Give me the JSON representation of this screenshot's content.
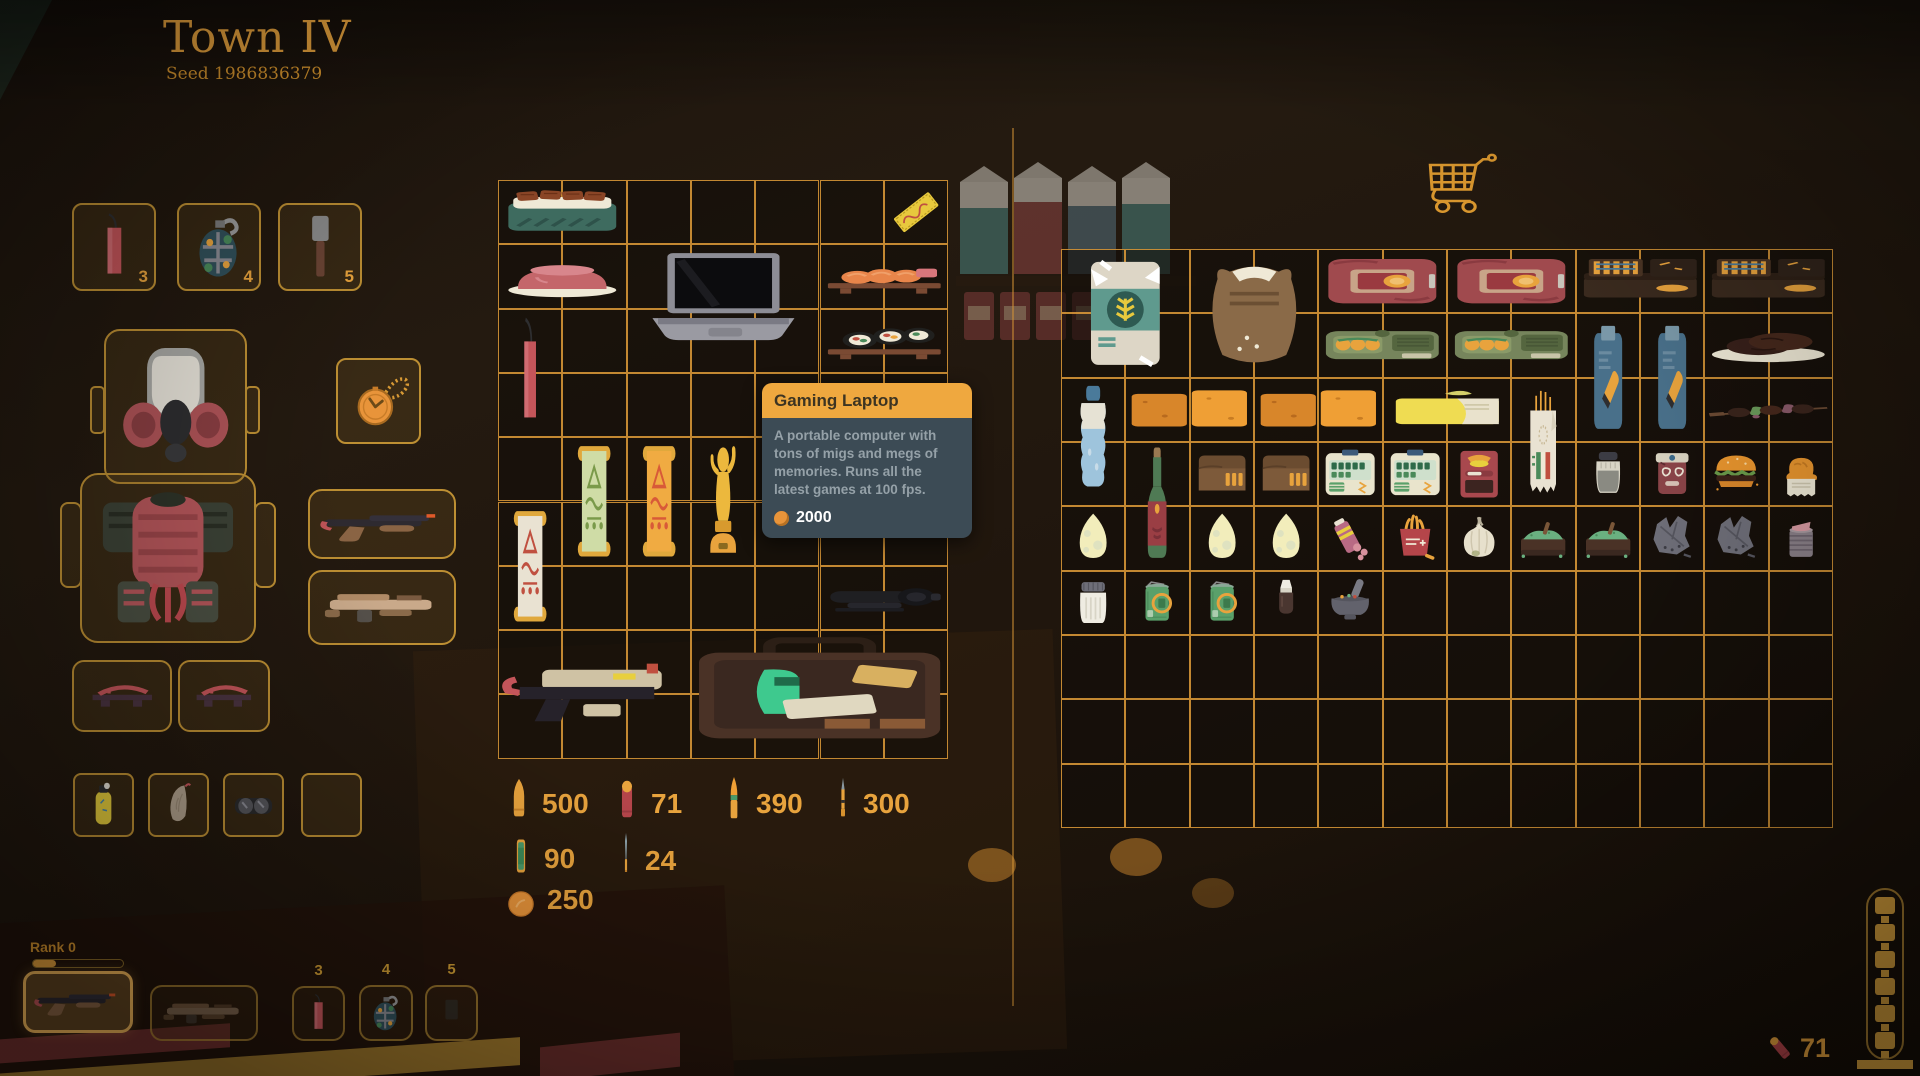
{
  "header": {
    "title": "Town IV",
    "seed": "Seed 1986836379"
  },
  "colors": {
    "accent_orange": "#e8a33d",
    "grid_line": "#de9e3a",
    "tooltip_header_bg": "#efa83f",
    "tooltip_body_bg": "#3c4b55",
    "tooltip_text": "#95a1a8",
    "selected_slot": "#f2b659"
  },
  "equipment": {
    "quick_slots": [
      {
        "name": "dynamite",
        "icon": "dynamite",
        "count": "3"
      },
      {
        "name": "grenade",
        "icon": "grenade",
        "count": "4"
      },
      {
        "name": "stick-grenade",
        "icon": "stick-grenade",
        "count": "5"
      }
    ],
    "head": {
      "icon": "gas-mask"
    },
    "trinket": {
      "icon": "pocket-watch"
    },
    "body": {
      "icon": "samurai-armor"
    },
    "weapons": [
      {
        "name": "shotgun",
        "icon": "shotgun"
      },
      {
        "name": "rifle",
        "icon": "smg"
      }
    ],
    "shoes": [
      {
        "icon": "geta"
      },
      {
        "icon": "geta"
      }
    ],
    "misc": [
      {
        "icon": "canister-yellow"
      },
      {
        "icon": "lung"
      },
      {
        "icon": "goggles"
      },
      {
        "icon": null
      }
    ]
  },
  "player_grid": {
    "cols": 7,
    "rows": 9,
    "items": [
      {
        "name": "unagi-bento",
        "icon": "unagi-bento",
        "col": 0,
        "row": 0,
        "w": 2,
        "h": 1
      },
      {
        "name": "golden-ticket",
        "icon": "golden-ticket",
        "col": 6,
        "row": 0,
        "w": 1,
        "h": 1
      },
      {
        "name": "ham-plate",
        "icon": "ham-plate",
        "col": 0,
        "row": 1,
        "w": 2,
        "h": 1
      },
      {
        "name": "gaming-laptop",
        "icon": "laptop",
        "col": 2,
        "row": 1,
        "w": 3,
        "h": 2
      },
      {
        "name": "salmon-sushi-board",
        "icon": "sushi-board",
        "col": 5,
        "row": 1,
        "w": 2,
        "h": 1
      },
      {
        "name": "maki-roll-board",
        "icon": "maki-board",
        "col": 5,
        "row": 2,
        "w": 2,
        "h": 1
      },
      {
        "name": "dynamite-stick",
        "icon": "dynamite",
        "col": 0,
        "row": 2,
        "w": 1,
        "h": 2
      },
      {
        "name": "scroll-green",
        "icon": "scroll-green",
        "col": 1,
        "row": 4,
        "w": 1,
        "h": 2
      },
      {
        "name": "scroll-orange",
        "icon": "scroll-orange",
        "col": 2,
        "row": 4,
        "w": 1,
        "h": 2
      },
      {
        "name": "gold-trophy",
        "icon": "trophy",
        "col": 3,
        "row": 4,
        "w": 1,
        "h": 2
      },
      {
        "name": "drink-cup",
        "icon": "drink-cup",
        "col": 6,
        "row": 4,
        "w": 1,
        "h": 2
      },
      {
        "name": "scroll-white",
        "icon": "scroll-white",
        "col": 0,
        "row": 5,
        "w": 1,
        "h": 2
      },
      {
        "name": "rifle-scope",
        "icon": "scope",
        "col": 5,
        "row": 6,
        "w": 2,
        "h": 1
      },
      {
        "name": "pistol",
        "icon": "pistol-tan",
        "col": 0,
        "row": 7,
        "w": 3,
        "h": 2
      },
      {
        "name": "toolbox",
        "icon": "toolbox",
        "col": 3,
        "row": 7,
        "w": 4,
        "h": 2
      }
    ]
  },
  "tooltip": {
    "title": "Gaming Laptop",
    "description": "A portable computer with tons of migs and megs of memories. Runs all the latest games at 100 fps.",
    "price": "2000"
  },
  "ammo": {
    "counters": [
      {
        "icon": "bullet-pistol",
        "count": "500"
      },
      {
        "icon": "shell-red",
        "count": "71"
      },
      {
        "icon": "bullet-rifle",
        "count": "390"
      },
      {
        "icon": "bullet-sniper",
        "count": "300"
      },
      {
        "icon": "battery-green",
        "count": "90"
      },
      {
        "icon": "dart-blue",
        "count": "24"
      },
      {
        "icon": "coin",
        "count": "250"
      }
    ]
  },
  "shop": {
    "cart_icon": "cart",
    "grid": {
      "cols": 12,
      "rows": 9,
      "items": [
        {
          "name": "flour-bag",
          "icon": "flour-bag",
          "col": 0,
          "row": 0,
          "w": 2,
          "h": 2
        },
        {
          "name": "flour-sack",
          "icon": "flour-sack",
          "col": 2,
          "row": 0,
          "w": 2,
          "h": 2
        },
        {
          "name": "canned-ham",
          "icon": "canned-ham",
          "col": 4,
          "row": 0,
          "w": 2,
          "h": 1
        },
        {
          "name": "canned-ham",
          "icon": "canned-ham",
          "col": 6,
          "row": 0,
          "w": 2,
          "h": 1
        },
        {
          "name": "ammo-crate",
          "icon": "ammo-box",
          "col": 8,
          "row": 0,
          "w": 2,
          "h": 1
        },
        {
          "name": "ammo-crate",
          "icon": "ammo-box",
          "col": 10,
          "row": 0,
          "w": 2,
          "h": 1
        },
        {
          "name": "sardine-tin",
          "icon": "sardine-tin",
          "col": 4,
          "row": 1,
          "w": 2,
          "h": 1
        },
        {
          "name": "sardine-tin",
          "icon": "sardine-tin",
          "col": 6,
          "row": 1,
          "w": 2,
          "h": 1
        },
        {
          "name": "bullet-packet",
          "icon": "seed-packet",
          "col": 8,
          "row": 1,
          "w": 1,
          "h": 2
        },
        {
          "name": "bullet-packet",
          "icon": "seed-packet",
          "col": 9,
          "row": 1,
          "w": 1,
          "h": 2
        },
        {
          "name": "steak-plate",
          "icon": "steak-plate",
          "col": 10,
          "row": 1,
          "w": 2,
          "h": 1
        },
        {
          "name": "water-bottle",
          "icon": "water-bottle",
          "col": 0,
          "row": 2,
          "w": 1,
          "h": 2
        },
        {
          "name": "butter-boxes",
          "icon": "butter-box",
          "col": 1,
          "row": 2,
          "w": 2,
          "h": 1
        },
        {
          "name": "butter-boxes",
          "icon": "butter-box",
          "col": 3,
          "row": 2,
          "w": 2,
          "h": 1
        },
        {
          "name": "butter",
          "icon": "butter",
          "col": 5,
          "row": 2,
          "w": 2,
          "h": 1
        },
        {
          "name": "baguette",
          "icon": "baguette-wrap",
          "col": 7,
          "row": 2,
          "w": 1,
          "h": 2
        },
        {
          "name": "kebab-skewer",
          "icon": "kebab",
          "col": 10,
          "row": 2,
          "w": 2,
          "h": 1
        },
        {
          "name": "wine-bottle",
          "icon": "wine-bottle",
          "col": 1,
          "row": 3,
          "w": 1,
          "h": 2
        },
        {
          "name": "ammo-pouch",
          "icon": "wallet-pouch",
          "col": 2,
          "row": 3,
          "w": 1,
          "h": 1
        },
        {
          "name": "ammo-pouch",
          "icon": "wallet-pouch",
          "col": 3,
          "row": 3,
          "w": 1,
          "h": 1
        },
        {
          "name": "ration-box",
          "icon": "ration-box",
          "col": 4,
          "row": 3,
          "w": 1,
          "h": 1
        },
        {
          "name": "ration-box",
          "icon": "ration-box",
          "col": 5,
          "row": 3,
          "w": 1,
          "h": 1
        },
        {
          "name": "snack-pack",
          "icon": "snack-red",
          "col": 6,
          "row": 3,
          "w": 1,
          "h": 1
        },
        {
          "name": "pepper-shaker",
          "icon": "pepper-shaker",
          "col": 8,
          "row": 3,
          "w": 1,
          "h": 1
        },
        {
          "name": "jam-jar",
          "icon": "jam-jar",
          "col": 9,
          "row": 3,
          "w": 1,
          "h": 1
        },
        {
          "name": "burger",
          "icon": "burger",
          "col": 10,
          "row": 3,
          "w": 1,
          "h": 1
        },
        {
          "name": "fried-chicken",
          "icon": "fried-chicken",
          "col": 11,
          "row": 3,
          "w": 1,
          "h": 1
        },
        {
          "name": "egg",
          "icon": "egg",
          "col": 0,
          "row": 4,
          "w": 1,
          "h": 1
        },
        {
          "name": "egg",
          "icon": "egg",
          "col": 2,
          "row": 4,
          "w": 1,
          "h": 1
        },
        {
          "name": "egg",
          "icon": "egg",
          "col": 3,
          "row": 4,
          "w": 1,
          "h": 1
        },
        {
          "name": "candy-pack",
          "icon": "candy-pink",
          "col": 4,
          "row": 4,
          "w": 1,
          "h": 1
        },
        {
          "name": "fries",
          "icon": "fries-red",
          "col": 5,
          "row": 4,
          "w": 1,
          "h": 1
        },
        {
          "name": "garlic",
          "icon": "garlic",
          "col": 6,
          "row": 4,
          "w": 1,
          "h": 1
        },
        {
          "name": "powder-box",
          "icon": "powder-box",
          "col": 7,
          "row": 4,
          "w": 1,
          "h": 1
        },
        {
          "name": "powder-box",
          "icon": "powder-box",
          "col": 8,
          "row": 4,
          "w": 1,
          "h": 1
        },
        {
          "name": "metal-scrap",
          "icon": "metal-scrap",
          "col": 9,
          "row": 4,
          "w": 1,
          "h": 1
        },
        {
          "name": "metal-scrap",
          "icon": "metal-scrap",
          "col": 10,
          "row": 4,
          "w": 1,
          "h": 1
        },
        {
          "name": "open-can",
          "icon": "canned-open",
          "col": 11,
          "row": 4,
          "w": 1,
          "h": 1
        },
        {
          "name": "salt-shaker",
          "icon": "salt-shaker",
          "col": 0,
          "row": 5,
          "w": 1,
          "h": 1
        },
        {
          "name": "green-can",
          "icon": "green-can",
          "col": 1,
          "row": 5,
          "w": 1,
          "h": 1
        },
        {
          "name": "green-can",
          "icon": "green-can",
          "col": 2,
          "row": 5,
          "w": 1,
          "h": 1
        },
        {
          "name": "dropper-bottle",
          "icon": "dropper",
          "col": 3,
          "row": 5,
          "w": 1,
          "h": 1
        },
        {
          "name": "mortar-pestle",
          "icon": "mortar-pestle",
          "col": 4,
          "row": 5,
          "w": 1,
          "h": 1
        }
      ]
    }
  },
  "hotbar": {
    "rank_label": "Rank 0",
    "slots": [
      {
        "name": "hotbar-shotgun",
        "icon": "shotgun",
        "selected": true
      },
      {
        "name": "hotbar-rifle",
        "icon": "smg",
        "dim": true
      },
      {
        "name": "hotbar-dynamite",
        "num": "3",
        "icon": "dynamite"
      },
      {
        "name": "hotbar-grenade",
        "num": "4",
        "icon": "grenade"
      },
      {
        "name": "hotbar-slot-5",
        "num": "5",
        "icon": "faint-item",
        "dim": true
      }
    ]
  },
  "status": {
    "shell_count": "71",
    "magazine_segments": 6
  }
}
